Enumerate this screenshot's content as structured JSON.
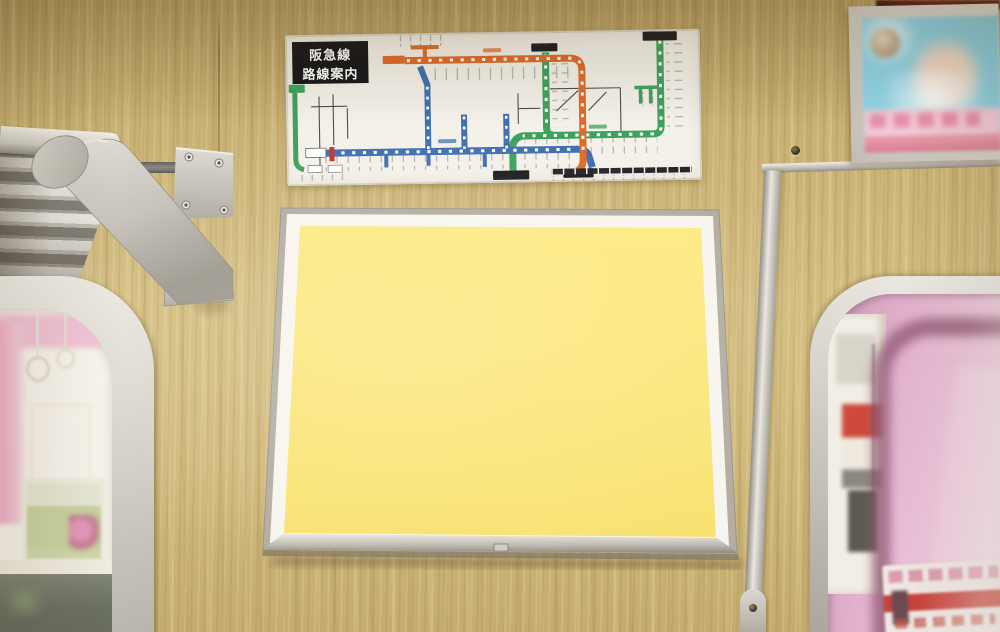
{
  "scene": {
    "type": "photograph",
    "subject": "train-interior-wall-with-route-map-and-blank-ad-panel"
  },
  "route_map_poster": {
    "title_line1": "阪急線",
    "title_line2": "路線案内",
    "paper_color": "#f4f1ea",
    "title_box_color": "#17171a",
    "lines": [
      {
        "name": "orange-line",
        "color": "#e06b28"
      },
      {
        "name": "blue-line",
        "color": "#4170b0"
      },
      {
        "name": "green-line",
        "color": "#3fa15e"
      },
      {
        "name": "red-segment",
        "color": "#c4342e"
      },
      {
        "name": "connecting-lines",
        "color": "#4e4e4e"
      }
    ],
    "station_marker_color": "#ffffff",
    "terminal_box_color": "#1d1d20"
  },
  "ad_panel": {
    "state": "blank",
    "fill_color": "#fbe87c",
    "mat_color": "#f7f5ef",
    "frame_color": "#b3ada2"
  },
  "top_right_poster": {
    "state": "blurred-advertisement",
    "sky_color": "#8ed3e6",
    "pink_band_color": "#f3c9d6"
  },
  "left_window": {
    "view": "overexposed-adjacent-train-interior"
  },
  "right_window": {
    "view": "pink-side-of-adjacent-train",
    "sticker": "blurred-red-white-notice"
  },
  "wall": {
    "material": "wood-grain-panel",
    "color": "#c9b073"
  },
  "hardware": {
    "rack": "aluminum-luggage-rack",
    "bracket": "aluminum-support-bracket",
    "fitting": "small-metal-fitting"
  }
}
